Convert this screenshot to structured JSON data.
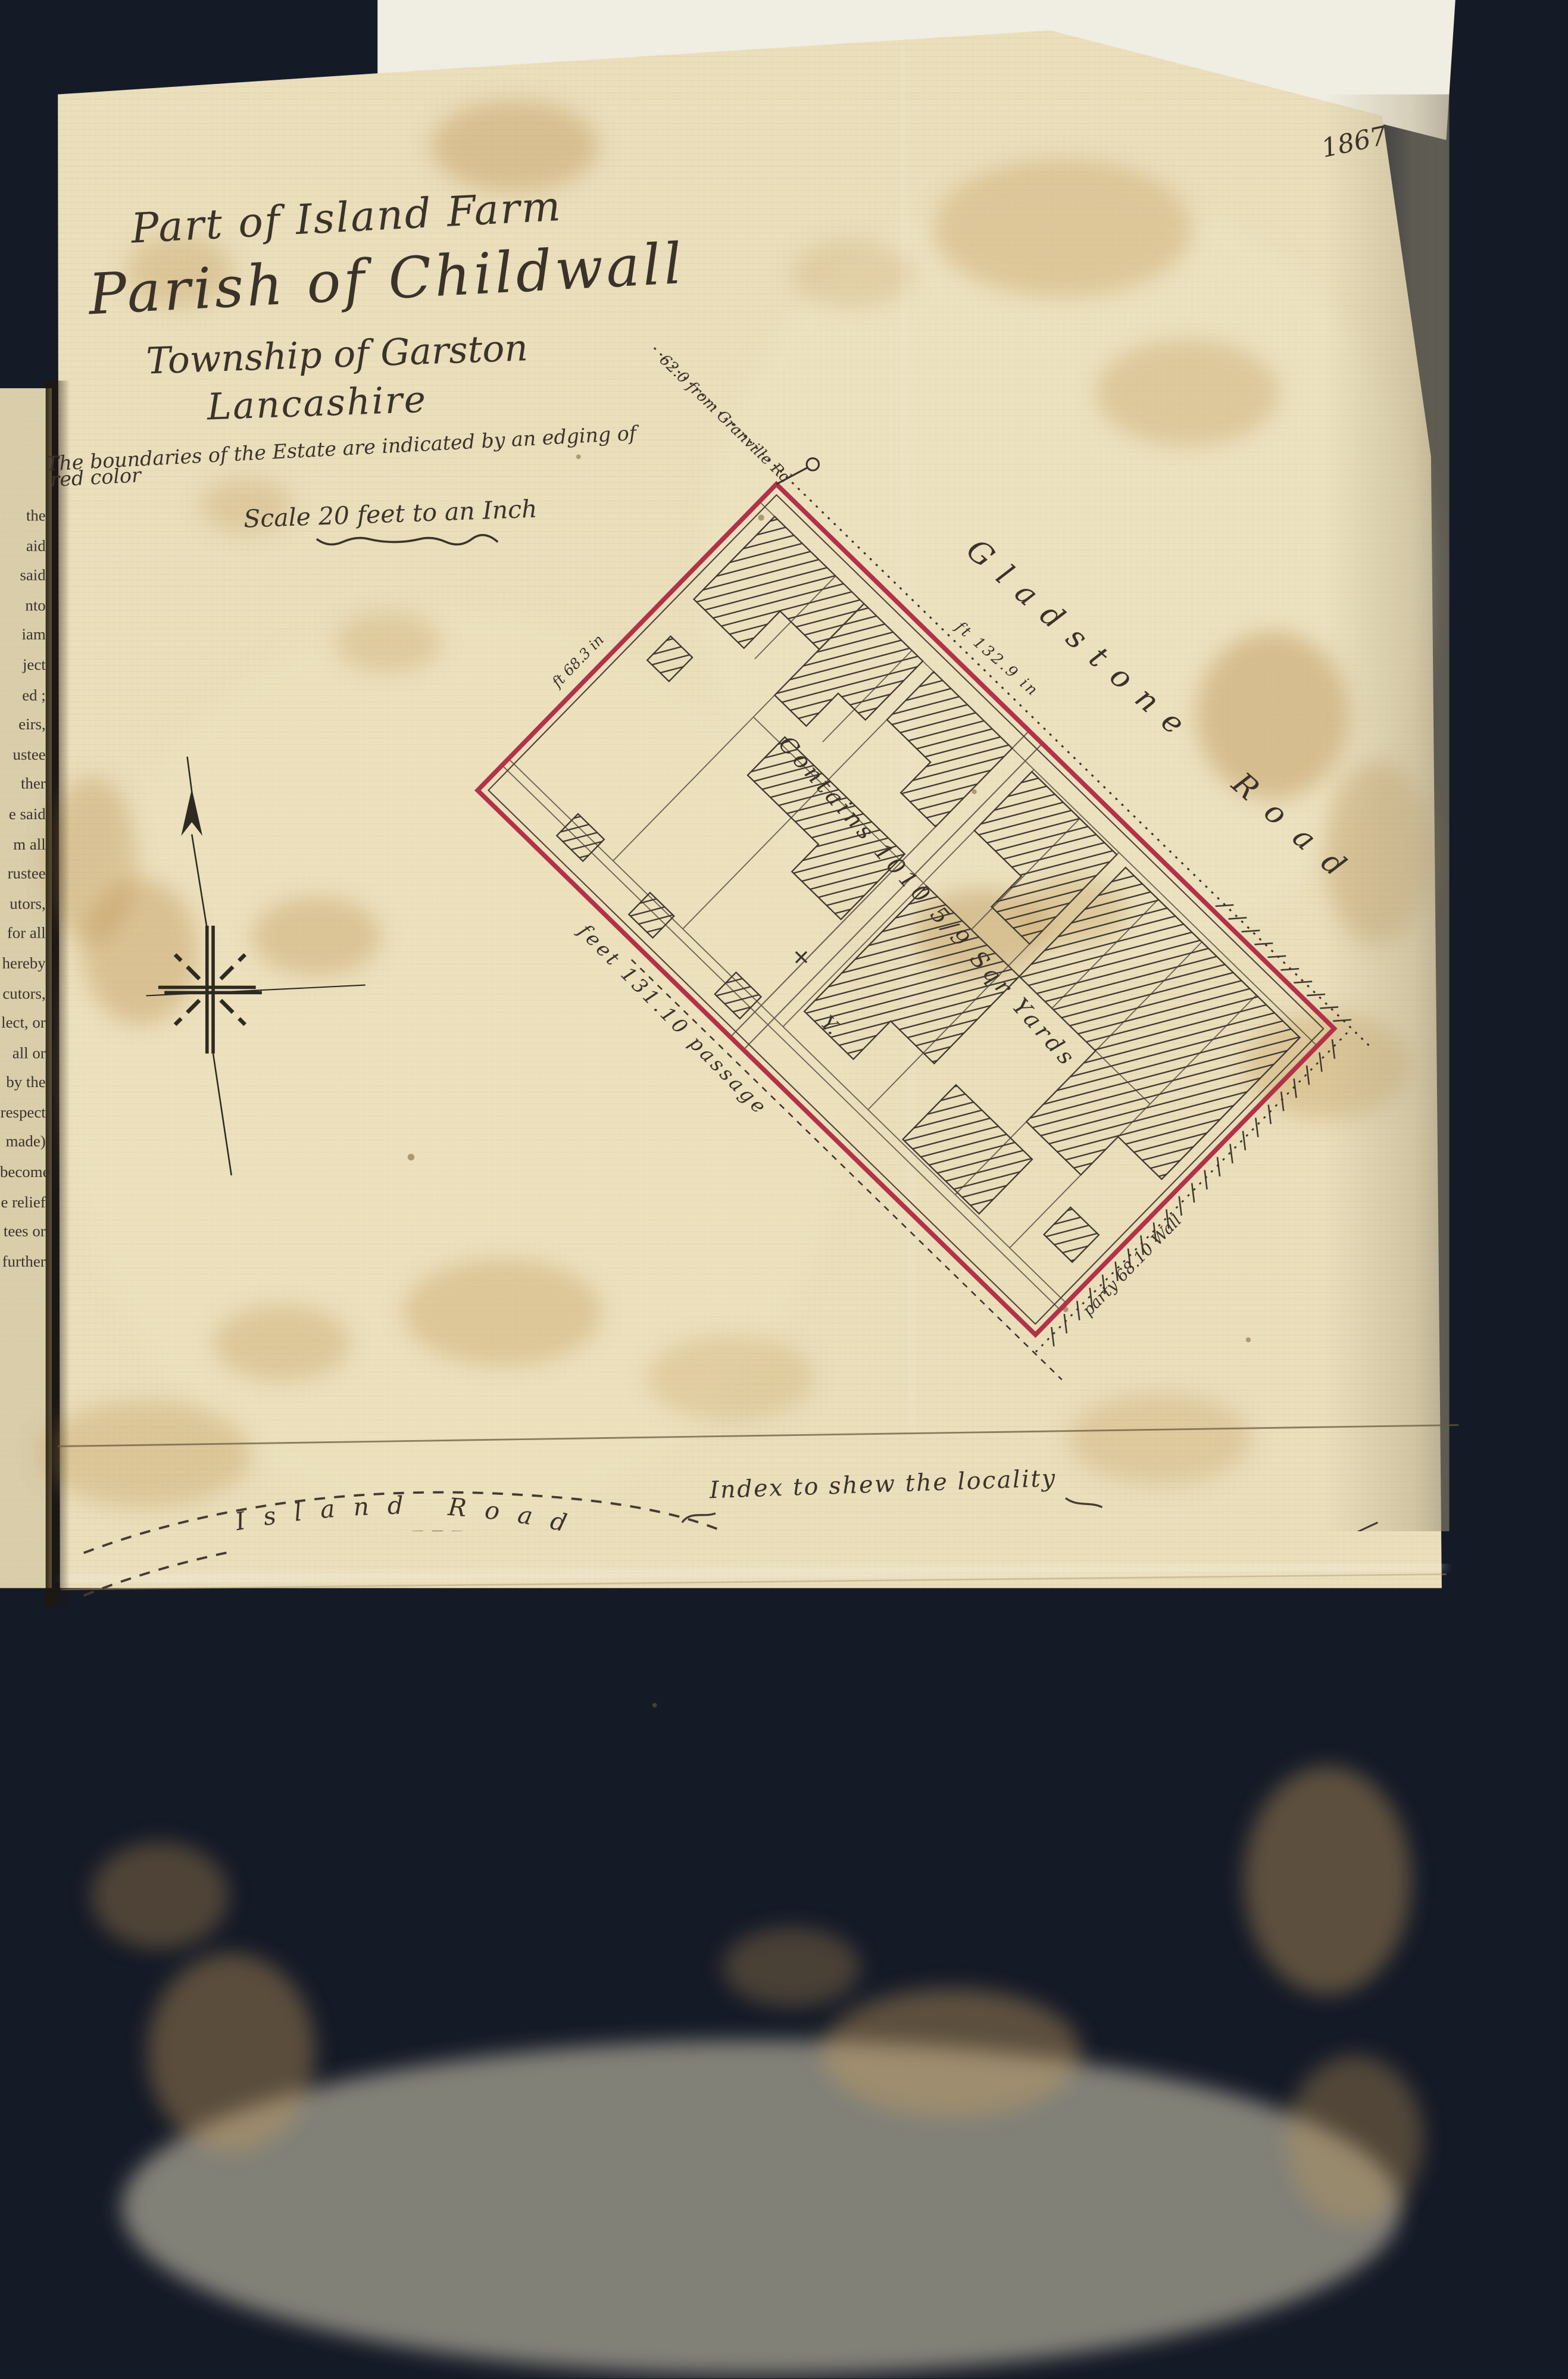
{
  "page": {
    "year_label": "1867",
    "background_color": "#151a27",
    "paper_color": "#eadebb",
    "boundary_red": "#b23248",
    "ink_color": "#3b332a"
  },
  "title": {
    "line1": "Part of Island Farm",
    "line2": "Parish of Childwall",
    "line3": "Township of Garston",
    "line4": "Lancashire"
  },
  "notes": {
    "boundary_note_line1": "The boundaries of the Estate are indicated by an edging of",
    "boundary_note_line2": "red color",
    "scale_note": "Scale 20 feet to an Inch"
  },
  "plan": {
    "road_label_word1": "Gladstone",
    "road_label_word2": "Road",
    "frontage_measurement": "ft 132.9 in",
    "nw_edge_measurement": "ft 68.3 in",
    "passage_label": "feet 131.10 passage",
    "party_wall_label": "party 68.10 Wall",
    "area_label": "Contains 1010 5/9 Sqr Yards",
    "corner_note": "62.0 from Granville Rd",
    "cross_mark": "+",
    "y_mark": "Y."
  },
  "index_map": {
    "heading": "Index to shew the locality",
    "roads": [
      {
        "name": "Island Road"
      },
      {
        "name": "Woolton Road"
      },
      {
        "name": "Argyle Road"
      },
      {
        "name": "Gladstone Rd"
      },
      {
        "name": "Palmerston Rd"
      },
      {
        "name": "Russell Road"
      },
      {
        "name": "Chancery Rd"
      }
    ],
    "landmark": "Red Lion Hotel"
  },
  "signature": {
    "line1": "Liverpool Land Co Lim",
    "line2": "22 Lord St Liverpool",
    "line3": "Thos Childs",
    "line4": "Secy"
  },
  "book_page_text": "the\naid\nsaid\nnto\niam\nject\ned ;\neirs,\nustee\nther\ne said\nm all\nrustee\nutors,\nfor all\nhereby\ncutors,\nlect, or\nall or\nby the\nrespect\nmade)\nbecome\ne relief\ntees or\nfurther"
}
